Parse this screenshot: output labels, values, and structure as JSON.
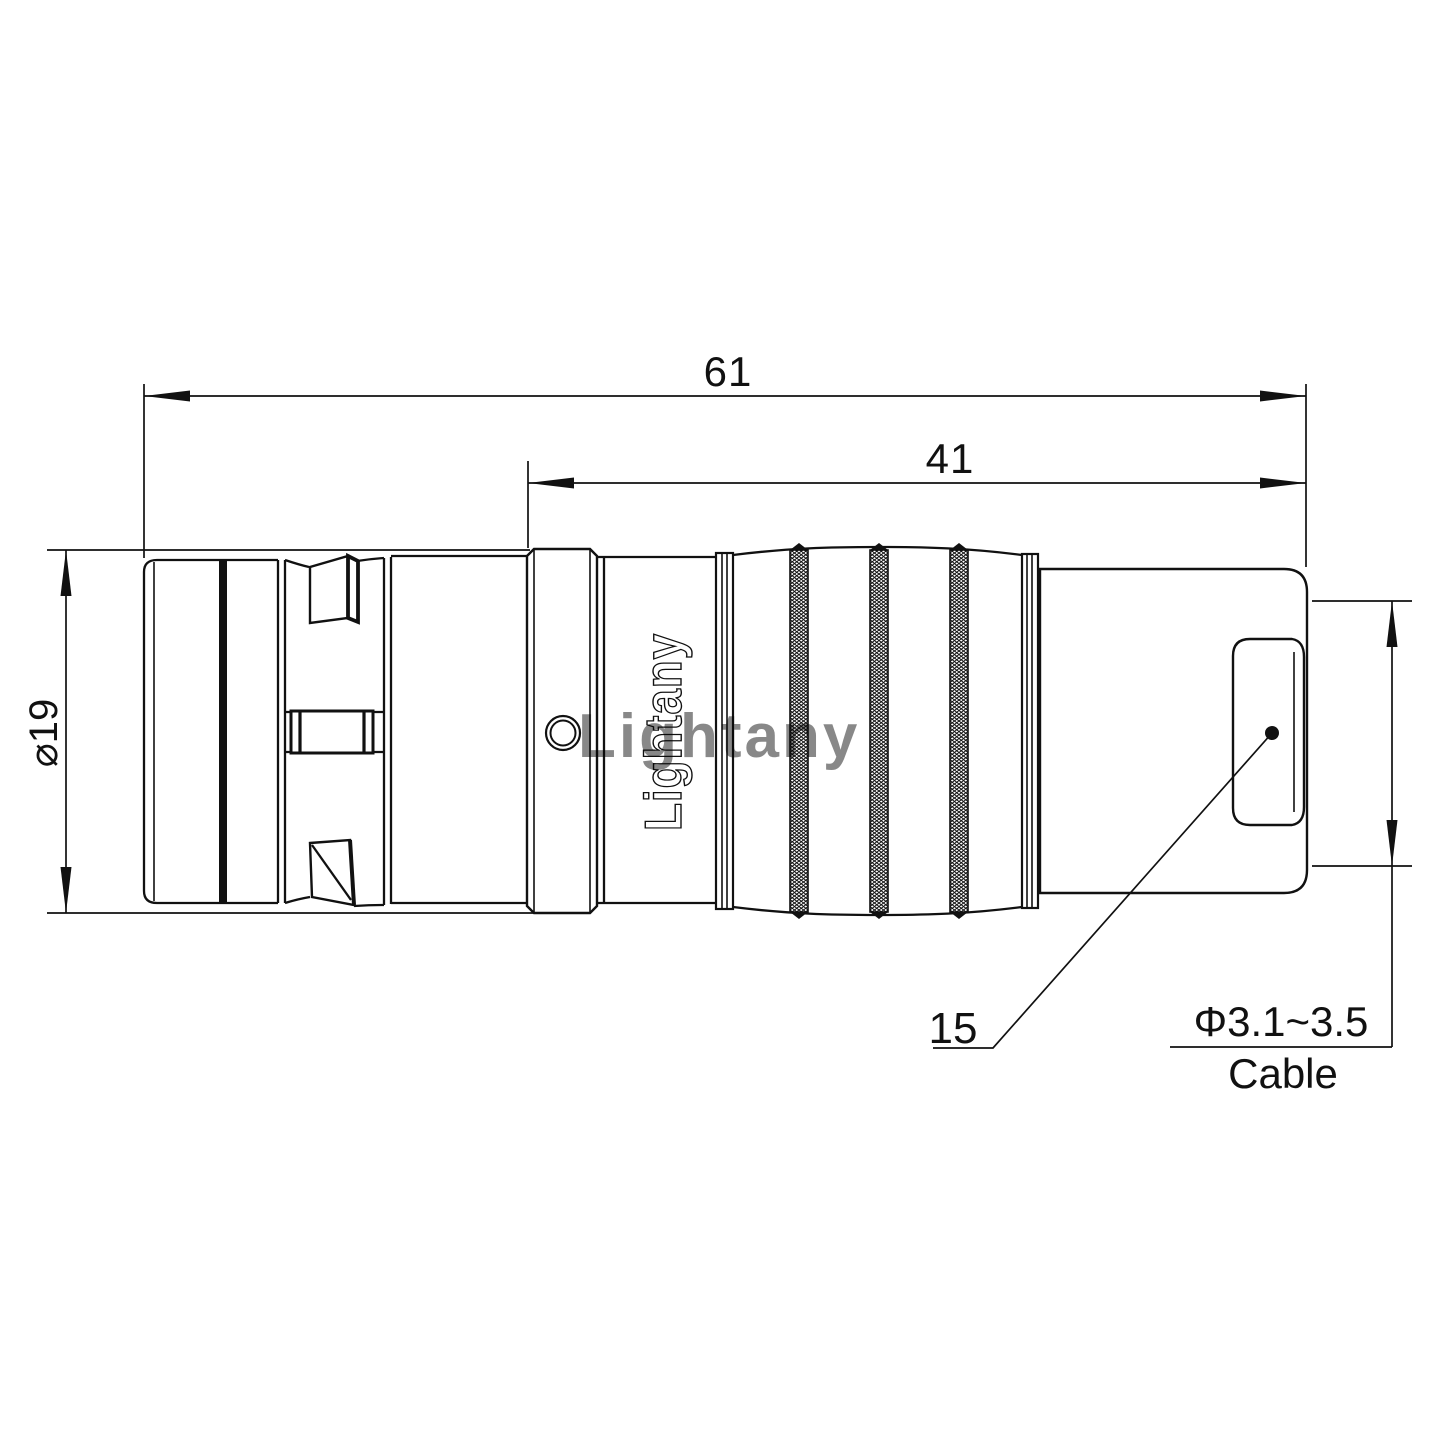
{
  "drawing": {
    "dims": {
      "overall_length": "61",
      "coupling_length": "41",
      "body_diameter": "⌀19",
      "boot_length": "15",
      "cable_diameter": "Φ3.1~3.5",
      "cable_label": "Cable"
    },
    "branding": {
      "logo_text": "Lightany",
      "watermark_text": "Lightany"
    },
    "colors": {
      "line": "#111111",
      "watermark": "#d98f8f"
    }
  }
}
